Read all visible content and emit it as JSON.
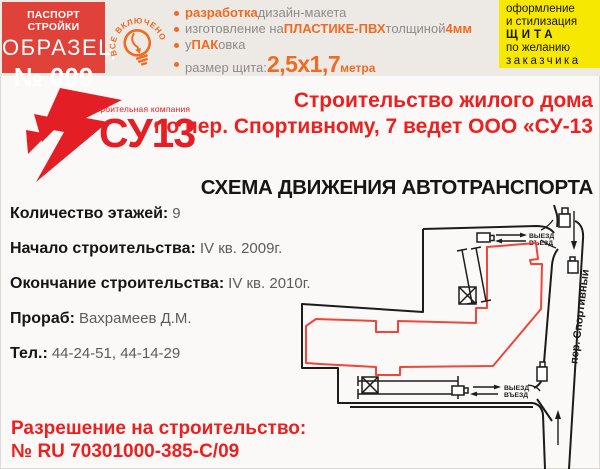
{
  "header": {
    "passport_box": {
      "line1": "ПАСПОРТ СТРОЙКИ",
      "line2": "ОБРАЗЕЦ",
      "line3": "№ 009"
    },
    "stamp_text": "ВСЕ ВКЛЮЧЕНО",
    "features": [
      {
        "parts": [
          {
            "t": "разработка",
            "hl": true
          },
          {
            "t": " дизайн-макета"
          }
        ]
      },
      {
        "parts": [
          {
            "t": "изготовление на "
          },
          {
            "t": "ПЛАСТИКЕ-ПВХ",
            "hl": true
          },
          {
            "t": " толщиной "
          },
          {
            "t": "4мм",
            "hl": true
          }
        ]
      },
      {
        "parts": [
          {
            "t": "у"
          },
          {
            "t": "ПАК",
            "hl": true
          },
          {
            "t": "овка"
          }
        ]
      },
      {
        "parts": [
          {
            "t": "размер щита: "
          },
          {
            "t": "2,5х1,7",
            "hl": true,
            "big": true
          },
          {
            "t": " метра",
            "hl": true,
            "small": true
          }
        ]
      }
    ],
    "offer_box": {
      "lines": [
        "оформление",
        "и стилизация",
        "ЩИТА",
        "по желанию",
        "заказчика"
      ]
    }
  },
  "brand": {
    "company_type": "Строительная компания",
    "name": "СУ13"
  },
  "title": {
    "line1": "Строительство жилого дома",
    "line2": "по пер. Спортивному, 7 ведет ООО «СУ-13"
  },
  "scheme": {
    "heading": "СХЕМА ДВИЖЕНИЯ АВТОТРАНСПОРТА",
    "street": "пер. Спортивный",
    "exit_label": "ВЫЕЗД",
    "enter_label": "ВЪЕЗД"
  },
  "details": [
    {
      "label": "Количество этажей:",
      "value": "9"
    },
    {
      "label": "Начало строительства:",
      "value": "IV кв. 2009г."
    },
    {
      "label": "Окончание строительства:",
      "value": "IV кв. 2010г."
    },
    {
      "label": "Прораб:",
      "value": "Вахрамеев Д.М."
    },
    {
      "label": "Тел.:",
      "value": "44-24-51, 44-14-29"
    }
  ],
  "permit": {
    "line1": "Разрешение на строительство:",
    "line2": "№ RU 70301000-385-С/09"
  },
  "colors": {
    "brand_red": "#e31e24",
    "box_red": "#e0423a",
    "accent_orange": "#f26a21",
    "highlight_yellow": "#f6e800",
    "building_outline_red": "#f0453b",
    "map_line_black": "#1c1c1c"
  }
}
